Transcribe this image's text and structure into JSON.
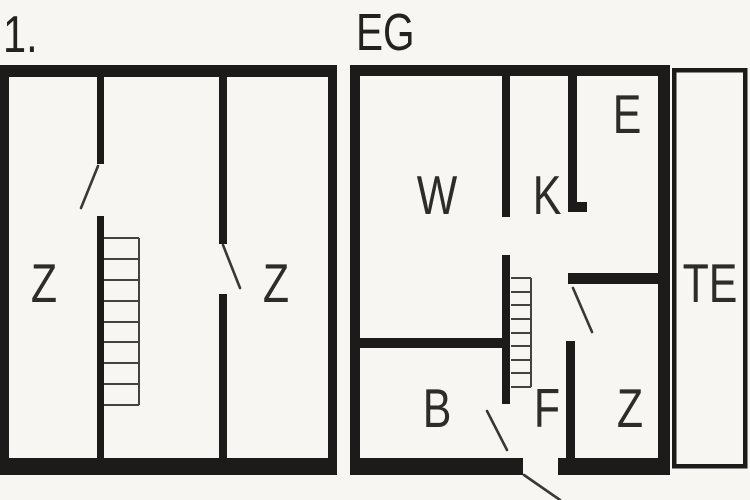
{
  "document": {
    "type": "floor-plan",
    "colors": {
      "background": "#f7f6f2",
      "wall": "#1d1b1a",
      "thin_line": "#45423f",
      "label": "#2e2b28"
    }
  },
  "floors": [
    {
      "id": "upper-floor",
      "label": "1.",
      "rooms": [
        {
          "id": "bedroom-left",
          "label": "Z"
        },
        {
          "id": "bedroom-right",
          "label": "Z"
        }
      ],
      "features": [
        "staircase-icon",
        "door-swing-icon",
        "door-swing-icon"
      ]
    },
    {
      "id": "ground-floor",
      "label": "EG",
      "rooms": [
        {
          "id": "living-room",
          "label": "W"
        },
        {
          "id": "kitchen",
          "label": "K"
        },
        {
          "id": "entry",
          "label": "E"
        },
        {
          "id": "bathroom",
          "label": "B"
        },
        {
          "id": "hallway",
          "label": "F"
        },
        {
          "id": "bedroom",
          "label": "Z"
        },
        {
          "id": "terrace",
          "label": "TE"
        }
      ],
      "features": [
        "staircase-icon",
        "door-swing-icon",
        "door-swing-icon",
        "entrance-door-swing-icon"
      ]
    }
  ]
}
